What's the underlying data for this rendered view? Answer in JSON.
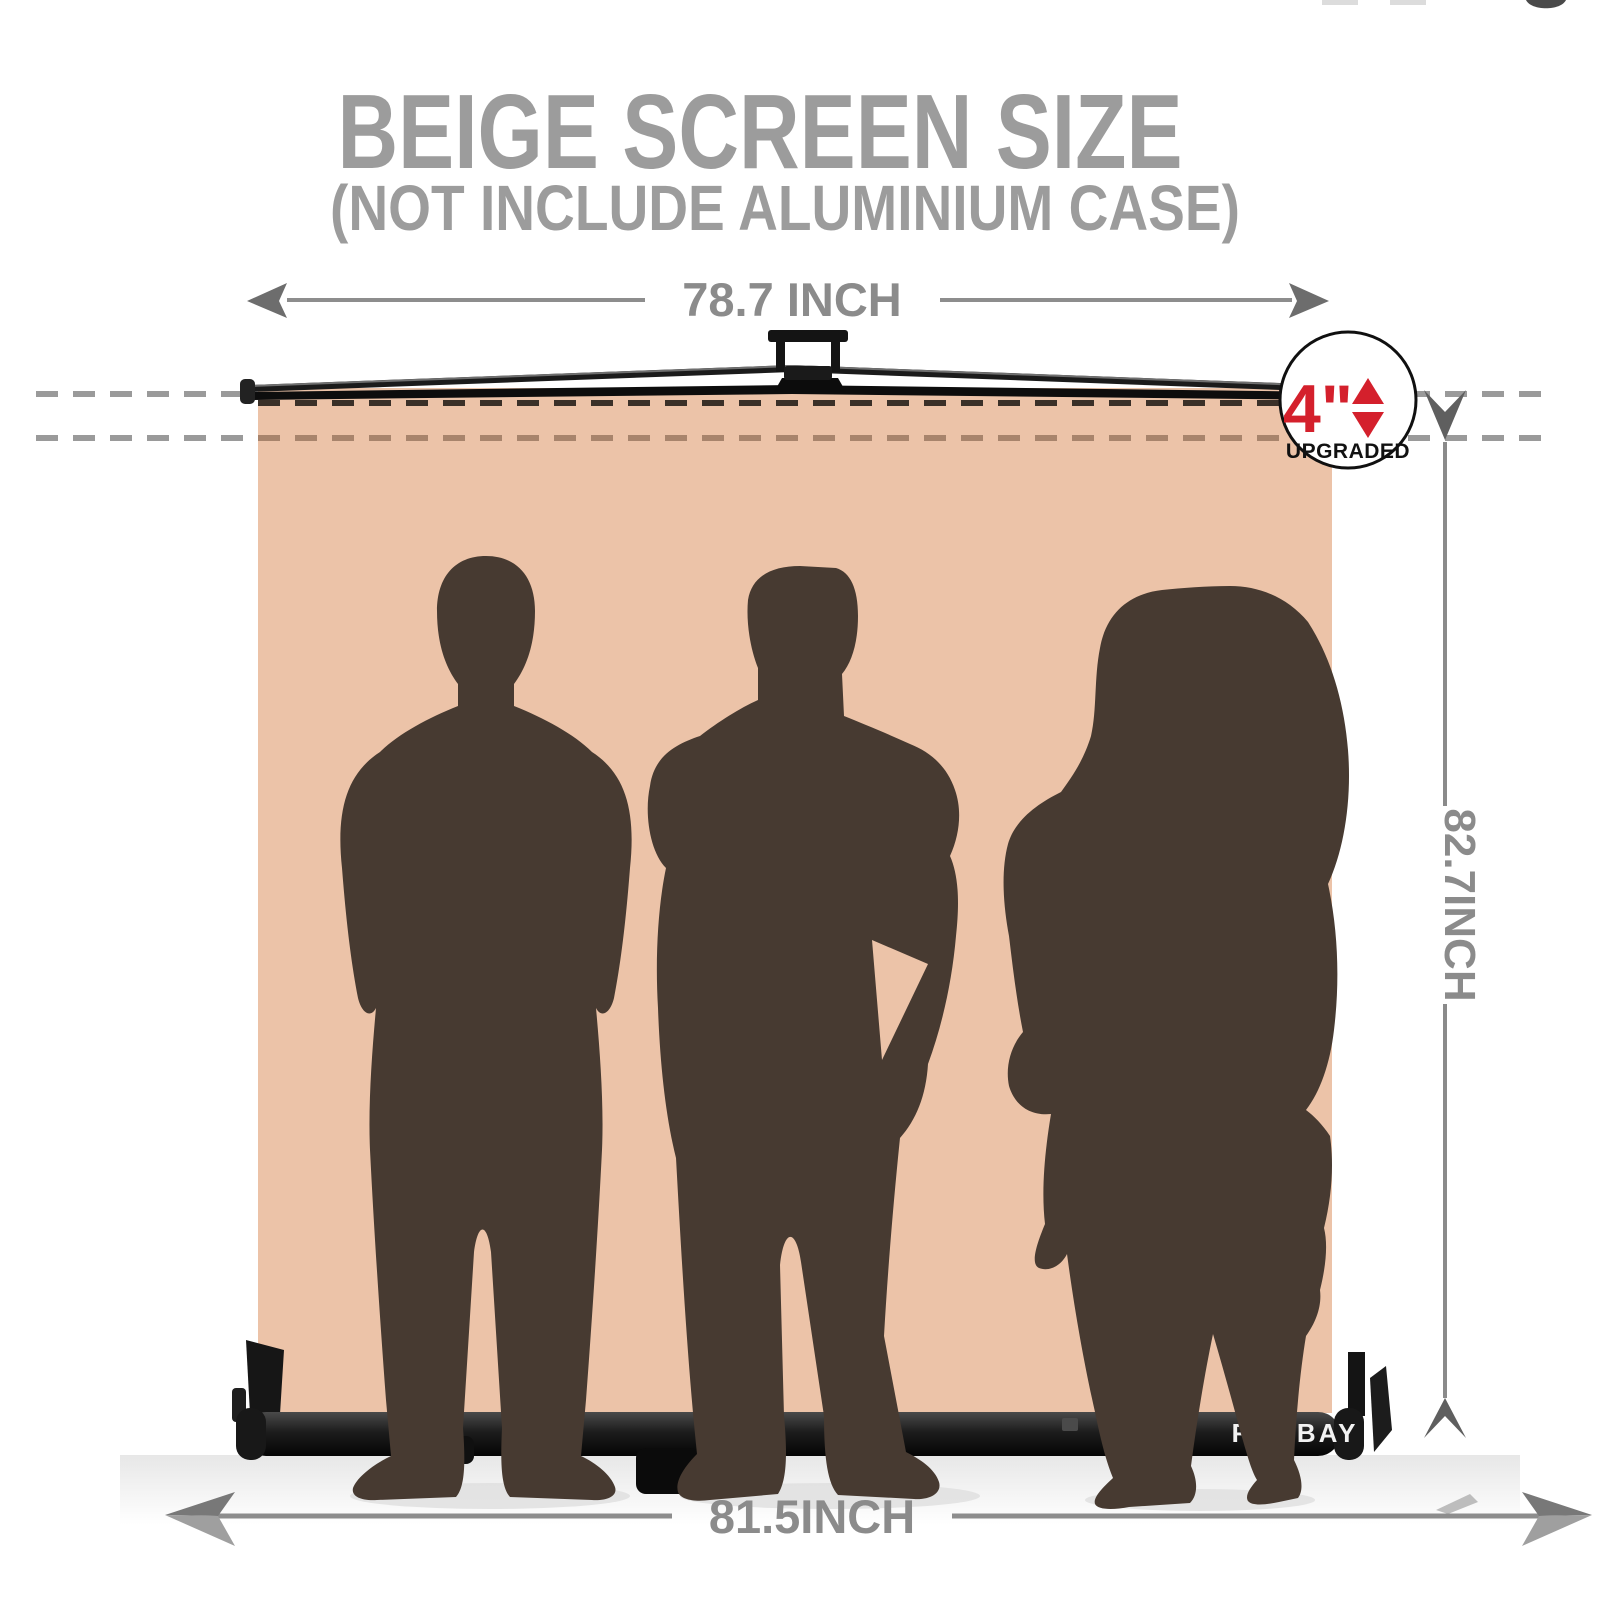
{
  "title": {
    "main": "BEIGE SCREEN SIZE",
    "sub": "(NOT INCLUDE ALUMINIUM CASE)"
  },
  "dims": {
    "top": "78.7 INCH",
    "right": "82.7INCH",
    "bottom": "81.5INCH"
  },
  "badge": {
    "value": "4\"",
    "label": "UPGRADED"
  },
  "brand": {
    "name": "RAUBAY"
  },
  "colors": {
    "beige": "#ecc3a8",
    "silhouette": "#473a31",
    "accent_red": "#d4202c",
    "title_gray": "#9c9c9c",
    "dimension_gray": "#8b8b8b",
    "frame_black": "#141414"
  }
}
